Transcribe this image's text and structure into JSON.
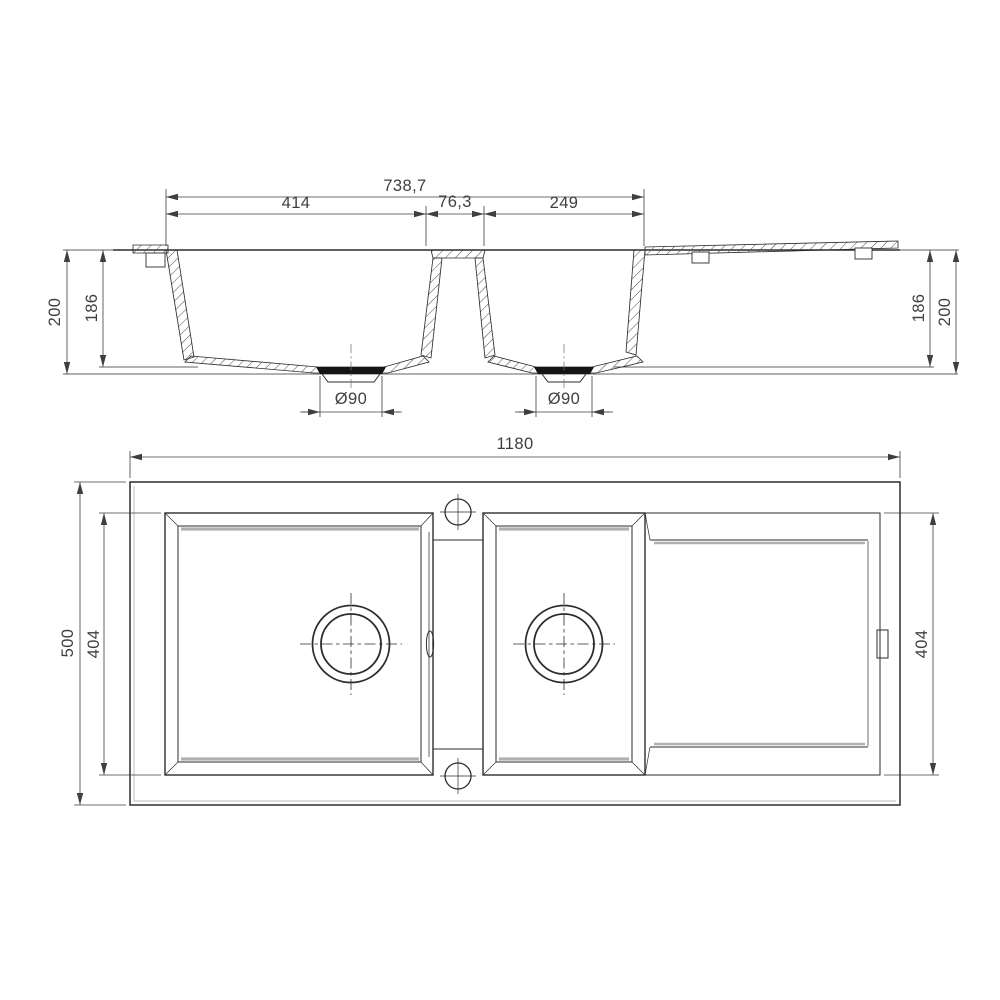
{
  "drawing": {
    "title": "double-bowl-sink-with-drainer-technical-drawing",
    "section_view": {
      "total_width": "738,7",
      "left_bowl_width": "414",
      "divider_width": "76,3",
      "right_bowl_width": "249",
      "left_outer_depth": "200",
      "left_inner_depth": "186",
      "right_inner_depth": "186",
      "right_outer_depth": "200",
      "left_drain_diameter": "Ø90",
      "right_drain_diameter": "Ø90"
    },
    "plan_view": {
      "overall_width": "1180",
      "overall_depth": "500",
      "bowl_depth": "404",
      "drainer_depth": "404"
    },
    "colors": {
      "line": "#2d2d2d",
      "dimension": "#3f3f3f",
      "shadow": "#b0b0b0",
      "background": "#ffffff"
    }
  }
}
